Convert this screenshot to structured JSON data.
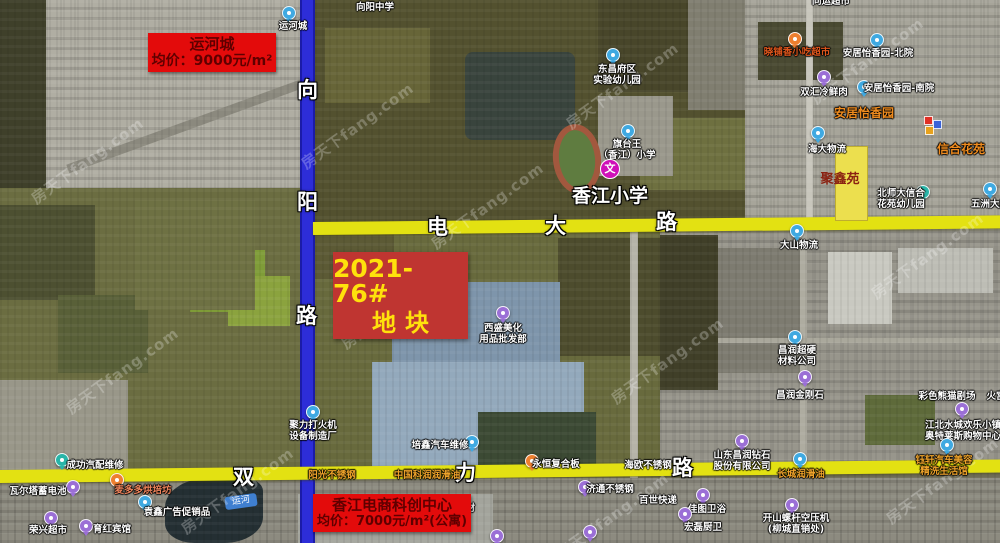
{
  "watermark": {
    "text": "房天下fang.com"
  },
  "price_labels": {
    "yunhecheng": {
      "title": "运河城",
      "price": "均价：9000元/m²"
    },
    "xiangjiang": {
      "title": "香江电商科创中心",
      "price": "均价：7000元/m²(公寓)"
    }
  },
  "parcel": {
    "code": "2021-76#",
    "label": "地块"
  },
  "parcel_yellow": {
    "label": "聚鑫苑"
  },
  "school": {
    "title": "香江小学",
    "icon_char": "文"
  },
  "canal_tag": "运河",
  "roads": {
    "xiangyang_lu": {
      "name": "向阳路",
      "chars": [
        "向",
        "阳",
        "路"
      ]
    },
    "dianda_lu": {
      "name": "电大路",
      "chars": [
        "电",
        "大",
        "路"
      ]
    },
    "shuangli_lu": {
      "name": "双力路",
      "chars": [
        "双",
        "力",
        "路"
      ]
    }
  },
  "pois": [
    {
      "id": "xiangyang-middle-school",
      "lines": [
        "向阳中学"
      ],
      "x": 375,
      "y": 2
    },
    {
      "id": "yunhecheng-pin",
      "lines": [
        "运河城"
      ],
      "x": 293,
      "y": 21,
      "pin": {
        "c": "blue",
        "x": 289,
        "y": 13
      }
    },
    {
      "id": "tongyun-supermarket",
      "lines": [
        "同运超市"
      ],
      "x": 831,
      "y": -4
    },
    {
      "id": "xiaopuxiang-snack-market",
      "lines": [
        "晓铺香小吃超市"
      ],
      "x": 797,
      "y": 47,
      "color": "#e0561c",
      "pin": {
        "c": "orange",
        "x": 795,
        "y": 39
      }
    },
    {
      "id": "anju-yixiangyuan-north",
      "lines": [
        "安居怡香园-北院"
      ],
      "x": 878,
      "y": 48,
      "pin": {
        "c": "blue",
        "x": 877,
        "y": 40
      }
    },
    {
      "id": "shuanghui-meat",
      "lines": [
        "双汇冷鲜肉"
      ],
      "x": 824,
      "y": 87,
      "pin": {
        "c": "purple",
        "x": 824,
        "y": 77
      }
    },
    {
      "id": "anju-yixiangyuan-south",
      "lines": [
        "安居怡香园-南院"
      ],
      "x": 899,
      "y": 83,
      "pin": {
        "c": "blue",
        "x": 864,
        "y": 87
      }
    },
    {
      "id": "anju-yixiangyuan",
      "lines": [
        "安居怡香园"
      ],
      "x": 864,
      "y": 106,
      "color": "#ef8b1e",
      "size": 12
    },
    {
      "id": "xinhe-huayuan",
      "lines": [
        "信合花苑"
      ],
      "x": 961,
      "y": 142,
      "color": "#ef8b1e",
      "size": 12
    },
    {
      "id": "haida-logistics",
      "lines": [
        "海大物流"
      ],
      "x": 827,
      "y": 144,
      "pin": {
        "c": "blue",
        "x": 818,
        "y": 133
      }
    },
    {
      "id": "beishida-xinhe-kindergarten",
      "lines": [
        "北师大信合",
        "花苑幼儿园"
      ],
      "x": 901,
      "y": 188,
      "pin": {
        "c": "teal",
        "x": 923,
        "y": 192
      }
    },
    {
      "id": "wuzhou-building",
      "lines": [
        "五洲大厦"
      ],
      "x": 990,
      "y": 199,
      "pin": {
        "c": "blue",
        "x": 990,
        "y": 189
      }
    },
    {
      "id": "dashan-logistics",
      "lines": [
        "大山物流"
      ],
      "x": 799,
      "y": 240,
      "pin": {
        "c": "blue",
        "x": 797,
        "y": 231
      }
    },
    {
      "id": "changrun-materials",
      "lines": [
        "昌润超硬",
        "材料公司"
      ],
      "x": 797,
      "y": 345,
      "pin": {
        "c": "blue",
        "x": 795,
        "y": 337
      }
    },
    {
      "id": "changrun-diamond",
      "lines": [
        "昌润金刚石"
      ],
      "x": 800,
      "y": 390,
      "pin": {
        "c": "purple",
        "x": 805,
        "y": 377
      }
    },
    {
      "id": "caise-panda-theater",
      "lines": [
        "彩色熊猫剧场"
      ],
      "x": 947,
      "y": 391
    },
    {
      "id": "huogong",
      "lines": [
        "火宫"
      ],
      "x": 996,
      "y": 391
    },
    {
      "id": "jiangbei-shuicheng-outlets",
      "lines": [
        "江北水城欢乐小镇",
        "奥特莱斯购物中心"
      ],
      "x": 963,
      "y": 420,
      "pin": {
        "c": "purple",
        "x": 962,
        "y": 409
      }
    },
    {
      "id": "yuxuan-car-beauty",
      "lines": [
        "钰轩汽车美容",
        "精洗生活馆"
      ],
      "x": 944,
      "y": 455,
      "color": "#efa32a",
      "pin": {
        "c": "blue",
        "x": 947,
        "y": 445
      }
    },
    {
      "id": "changcheng-lubricant",
      "lines": [
        "长城润滑油"
      ],
      "x": 801,
      "y": 469,
      "color": "#efa32a",
      "pin": {
        "c": "blue",
        "x": 800,
        "y": 459
      }
    },
    {
      "id": "shandong-changrun-diamond-co",
      "lines": [
        "山东昌润钻石",
        "股份有限公司"
      ],
      "x": 742,
      "y": 450,
      "pin": {
        "c": "purple",
        "x": 742,
        "y": 441
      }
    },
    {
      "id": "jitong-stainless",
      "lines": [
        "济通不锈钢"
      ],
      "x": 610,
      "y": 484,
      "pin": {
        "c": "purple",
        "x": 585,
        "y": 487
      }
    },
    {
      "id": "baishi-express",
      "lines": [
        "百世快递"
      ],
      "x": 658,
      "y": 495
    },
    {
      "id": "kaishan-compressor",
      "lines": [
        "开山螺杆空压机",
        "(柳城直销处)"
      ],
      "x": 796,
      "y": 513,
      "pin": {
        "c": "purple",
        "x": 792,
        "y": 505
      }
    },
    {
      "id": "jiatu-bathroom",
      "lines": [
        "佳图卫浴"
      ],
      "x": 707,
      "y": 504,
      "pin": {
        "c": "purple",
        "x": 703,
        "y": 495
      }
    },
    {
      "id": "honglei-kitchen-bath",
      "lines": [
        "宏磊厨卫"
      ],
      "x": 703,
      "y": 522,
      "pin": {
        "c": "purple",
        "x": 685,
        "y": 514
      }
    },
    {
      "id": "chenggong-auto-parts",
      "lines": [
        "成功汽配维修"
      ],
      "x": 95,
      "y": 460,
      "pin": {
        "c": "teal",
        "x": 62,
        "y": 460
      }
    },
    {
      "id": "waerta-battery",
      "lines": [
        "瓦尔塔蓄电池"
      ],
      "x": 38,
      "y": 486,
      "pin": {
        "c": "purple",
        "x": 73,
        "y": 487
      }
    },
    {
      "id": "maiduoduo-bakery",
      "lines": [
        "麦多多烘培坊"
      ],
      "x": 143,
      "y": 485,
      "color": "#f0845c",
      "pin": {
        "c": "orange",
        "x": 117,
        "y": 480
      }
    },
    {
      "id": "yuanxin-ads",
      "lines": [
        "袁鑫广告促销品"
      ],
      "x": 177,
      "y": 507,
      "pin": {
        "c": "blue",
        "x": 145,
        "y": 502
      }
    },
    {
      "id": "rongxing-supermarket",
      "lines": [
        "荣兴超市"
      ],
      "x": 48,
      "y": 525,
      "pin": {
        "c": "purple",
        "x": 51,
        "y": 518
      }
    },
    {
      "id": "yuhong-hotel",
      "lines": [
        "育红宾馆"
      ],
      "x": 112,
      "y": 524,
      "pin": {
        "c": "purple",
        "x": 86,
        "y": 526
      }
    },
    {
      "id": "juli-lighter-factory",
      "lines": [
        "聚力打火机",
        "设备制造厂"
      ],
      "x": 313,
      "y": 420,
      "pin": {
        "c": "blue",
        "x": 313,
        "y": 412
      }
    },
    {
      "id": "peixin-auto-repair",
      "lines": [
        "培鑫汽车维修"
      ],
      "x": 440,
      "y": 440,
      "pin": {
        "c": "blue",
        "x": 472,
        "y": 442
      }
    },
    {
      "id": "yangguang-stainless",
      "lines": [
        "阳光不锈钢"
      ],
      "x": 332,
      "y": 470,
      "color": "#efa32a"
    },
    {
      "id": "zhongguo-kerun-lubricant",
      "lines": [
        "中国科润润滑油"
      ],
      "x": 427,
      "y": 470,
      "color": "#efa32a"
    },
    {
      "id": "yongheng-composite-board",
      "lines": [
        "永恒复合板"
      ],
      "x": 556,
      "y": 459,
      "pin": {
        "c": "orange",
        "x": 532,
        "y": 461
      }
    },
    {
      "id": "haiou-stainless",
      "lines": [
        "海欧不锈钢"
      ],
      "x": 648,
      "y": 460
    },
    {
      "id": "aoda-aluminum",
      "lines": [
        "奥达铝材"
      ],
      "x": 456,
      "y": 503,
      "pin": {
        "c": "blue",
        "x": 432,
        "y": 502
      }
    },
    {
      "id": "xisheng-beauty-supplies",
      "lines": [
        "西盛美化",
        "用品批发部"
      ],
      "x": 503,
      "y": 323,
      "pin": {
        "c": "purple",
        "x": 503,
        "y": 313
      }
    },
    {
      "id": "qitaiwang-xiangjiang-school",
      "lines": [
        "旗台王",
        "（香江）小学"
      ],
      "x": 627,
      "y": 139,
      "pin": {
        "c": "blue",
        "x": 628,
        "y": 131
      }
    },
    {
      "id": "dongchangfu-kindergarten",
      "lines": [
        "东昌府区",
        "实验幼儿园"
      ],
      "x": 617,
      "y": 64,
      "pin": {
        "c": "blue",
        "x": 613,
        "y": 55
      }
    },
    {
      "id": "unlabeled-pin-1",
      "lines": [],
      "pin": {
        "c": "purple",
        "x": 497,
        "y": 536
      }
    },
    {
      "id": "unlabeled-pin-2",
      "lines": [],
      "pin": {
        "c": "purple",
        "x": 590,
        "y": 532
      }
    }
  ],
  "markers": [
    {
      "x": 924,
      "y": 116,
      "c": "#e03024"
    },
    {
      "x": 933,
      "y": 120,
      "c": "#3a62d8"
    },
    {
      "x": 925,
      "y": 126,
      "c": "#e8a21c"
    }
  ]
}
